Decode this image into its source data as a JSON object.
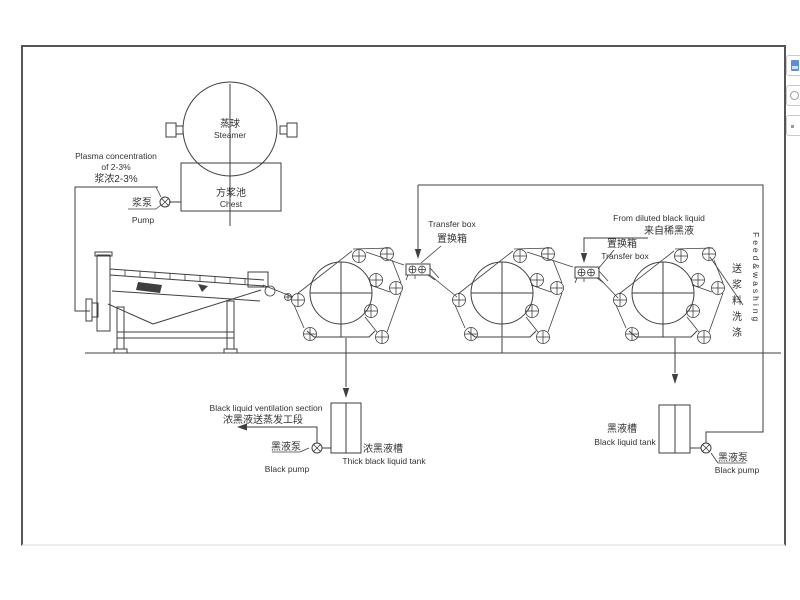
{
  "drawing": {
    "steamer": {
      "cn": "蒸球",
      "en": "Steamer"
    },
    "chest": {
      "cn": "方浆池",
      "en": "Chest"
    },
    "feed_note": {
      "en1": "Plasma concentration",
      "en2": "of 2-3%",
      "cn": "浆浓2-3%"
    },
    "pulp_pump": {
      "cn": "浆泵",
      "en": "Pump"
    },
    "transfer_box1": {
      "en": "Transfer box",
      "cn": "置换箱"
    },
    "transfer_box2": {
      "cn": "置换箱",
      "en": "Transfer box"
    },
    "diluted": {
      "en": "From diluted black liquid",
      "cn": "来自稀黑液"
    },
    "feed_washing": {
      "en": "Feed&washing",
      "cn": "送浆料洗涤"
    },
    "ventilation": {
      "en": "Black liquid ventilation section",
      "cn": "浓黑液送蒸发工段"
    },
    "pump_left": {
      "cn": "黑液泵",
      "en": "Black pump"
    },
    "tank_left": {
      "cn": "浓黑液槽",
      "en": "Thick black liquid tank"
    },
    "tank_right": {
      "cn": "黑液槽",
      "en": "Black liquid tank"
    },
    "pump_right": {
      "cn": "黑液泵",
      "en": "Black pump"
    }
  },
  "toolbar": {
    "buttons": [
      {
        "icon": "picture-icon"
      },
      {
        "icon": "circle-icon"
      },
      {
        "icon": "dot-icon"
      }
    ]
  },
  "colors": {
    "line": "#3f3f3f",
    "text": "#333333",
    "border": "#555555",
    "accent_blue": "#5b8fd9"
  }
}
